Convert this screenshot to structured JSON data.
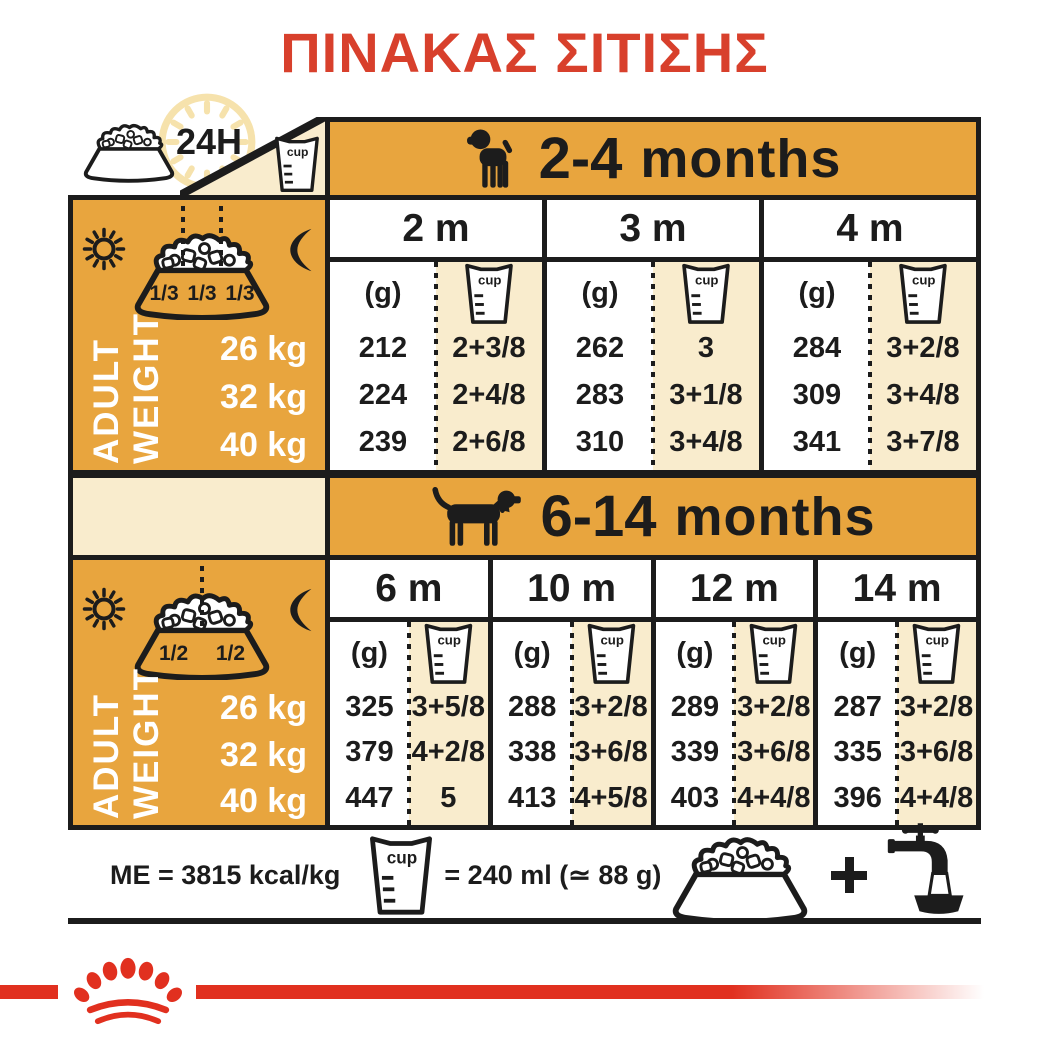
{
  "title": "ΠΙΝΑΚΑΣ ΣΙΤΙΣΗΣ",
  "always_feeding_label": "24H",
  "cup_label": "cup",
  "unit_grams": "(g)",
  "sections": [
    {
      "age_range": "2-4",
      "age_unit": "months",
      "bowl_fractions": [
        "1/3",
        "1/3",
        "1/3"
      ],
      "weight_label_words": [
        "ADULT",
        "WEIGHT"
      ],
      "weights": [
        "26 kg",
        "32 kg",
        "40 kg"
      ],
      "columns": [
        {
          "label": "2 m",
          "grams": [
            "212",
            "224",
            "239"
          ],
          "cups": [
            "2+3/8",
            "2+4/8",
            "2+6/8"
          ]
        },
        {
          "label": "3 m",
          "grams": [
            "262",
            "283",
            "310"
          ],
          "cups": [
            "3",
            "3+1/8",
            "3+4/8"
          ]
        },
        {
          "label": "4 m",
          "grams": [
            "284",
            "309",
            "341"
          ],
          "cups": [
            "3+2/8",
            "3+4/8",
            "3+7/8"
          ]
        }
      ]
    },
    {
      "age_range": "6-14",
      "age_unit": "months",
      "bowl_fractions": [
        "1/2",
        "1/2"
      ],
      "weight_label_words": [
        "ADULT",
        "WEIGHT"
      ],
      "weights": [
        "26 kg",
        "32 kg",
        "40 kg"
      ],
      "columns": [
        {
          "label": "6 m",
          "grams": [
            "325",
            "379",
            "447"
          ],
          "cups": [
            "3+5/8",
            "4+2/8",
            "5"
          ]
        },
        {
          "label": "10 m",
          "grams": [
            "288",
            "338",
            "413"
          ],
          "cups": [
            "3+2/8",
            "3+6/8",
            "4+5/8"
          ]
        },
        {
          "label": "12 m",
          "grams": [
            "289",
            "339",
            "403"
          ],
          "cups": [
            "3+2/8",
            "3+6/8",
            "4+4/8"
          ]
        },
        {
          "label": "14 m",
          "grams": [
            "287",
            "335",
            "396"
          ],
          "cups": [
            "3+2/8",
            "3+6/8",
            "4+4/8"
          ]
        }
      ]
    }
  ],
  "footer": {
    "energy_text": "ME = 3815 kcal/kg",
    "cup_equivalence": "= 240 ml (≃ 88 g)"
  },
  "colors": {
    "gold": "#E8A53E",
    "cream": "#F9ECCD",
    "title_red": "#D8402C",
    "brand_red": "#E1301F",
    "black": "#1C1C1C"
  }
}
